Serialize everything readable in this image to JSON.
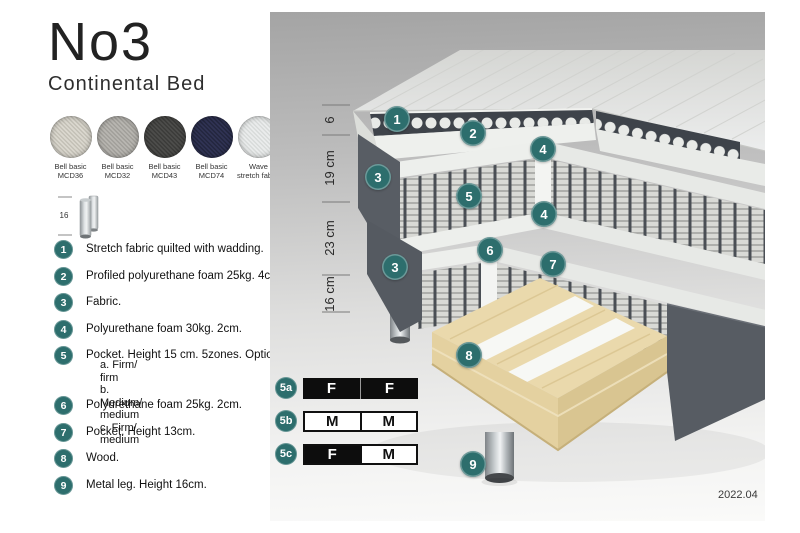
{
  "title": "No3",
  "subtitle": "Continental Bed",
  "colors": {
    "accent_teal": "#2d6e6d",
    "panel_top": "#a4a4a4",
    "panel_bottom": "#fafaf9",
    "wood": "#ead9ac",
    "fabric_dark_gray": "#575c63"
  },
  "swatches": [
    {
      "line1": "Bell basic",
      "line2": "MCD36",
      "color": "#dbd8cf"
    },
    {
      "line1": "Bell basic",
      "line2": "MCD32",
      "color": "#b8b6b1"
    },
    {
      "line1": "Bell basic",
      "line2": "MCD43",
      "color": "#4d4d4b"
    },
    {
      "line1": "Bell basic",
      "line2": "MCD74",
      "color": "#303354"
    },
    {
      "line1": "Wave",
      "line2": "stretch fabric",
      "color": "#eaecec"
    }
  ],
  "leg_icon": {
    "label": "16"
  },
  "list": {
    "items": [
      {
        "num": "1",
        "text": "Stretch fabric quilted with wadding."
      },
      {
        "num": "2",
        "text": "Profiled polyurethane foam 25kg. 4cm."
      },
      {
        "num": "3",
        "text": "Fabric."
      },
      {
        "num": "4",
        "text": "Polyurethane foam 30kg. 2cm."
      },
      {
        "num": "5",
        "text": "Pocket. Height 15 cm. 5zones. Option:",
        "options": [
          "a. Firm/ firm",
          "b. Medium/ medium",
          "c. Firm/ medium"
        ]
      },
      {
        "num": "6",
        "text": "Polyurethane foam 25kg. 2cm."
      },
      {
        "num": "7",
        "text": "Pocket. Height 13cm."
      },
      {
        "num": "8",
        "text": "Wood."
      },
      {
        "num": "9",
        "text": "Metal leg. Height 16cm."
      }
    ]
  },
  "diagram": {
    "dimensions": [
      "6",
      "19 cm",
      "23 cm",
      "16 cm"
    ],
    "callouts": [
      "1",
      "2",
      "3",
      "4",
      "5",
      "4",
      "6",
      "7",
      "3",
      "8",
      "9"
    ],
    "firmness": {
      "rows": [
        {
          "label": "5a",
          "cells": [
            {
              "letter": "F",
              "style": "dark"
            },
            {
              "letter": "F",
              "style": "dark"
            }
          ]
        },
        {
          "label": "5b",
          "cells": [
            {
              "letter": "M",
              "style": "light"
            },
            {
              "letter": "M",
              "style": "light"
            }
          ]
        },
        {
          "label": "5c",
          "cells": [
            {
              "letter": "F",
              "style": "dark"
            },
            {
              "letter": "M",
              "style": "light"
            }
          ]
        }
      ]
    },
    "date": "2022.04"
  }
}
